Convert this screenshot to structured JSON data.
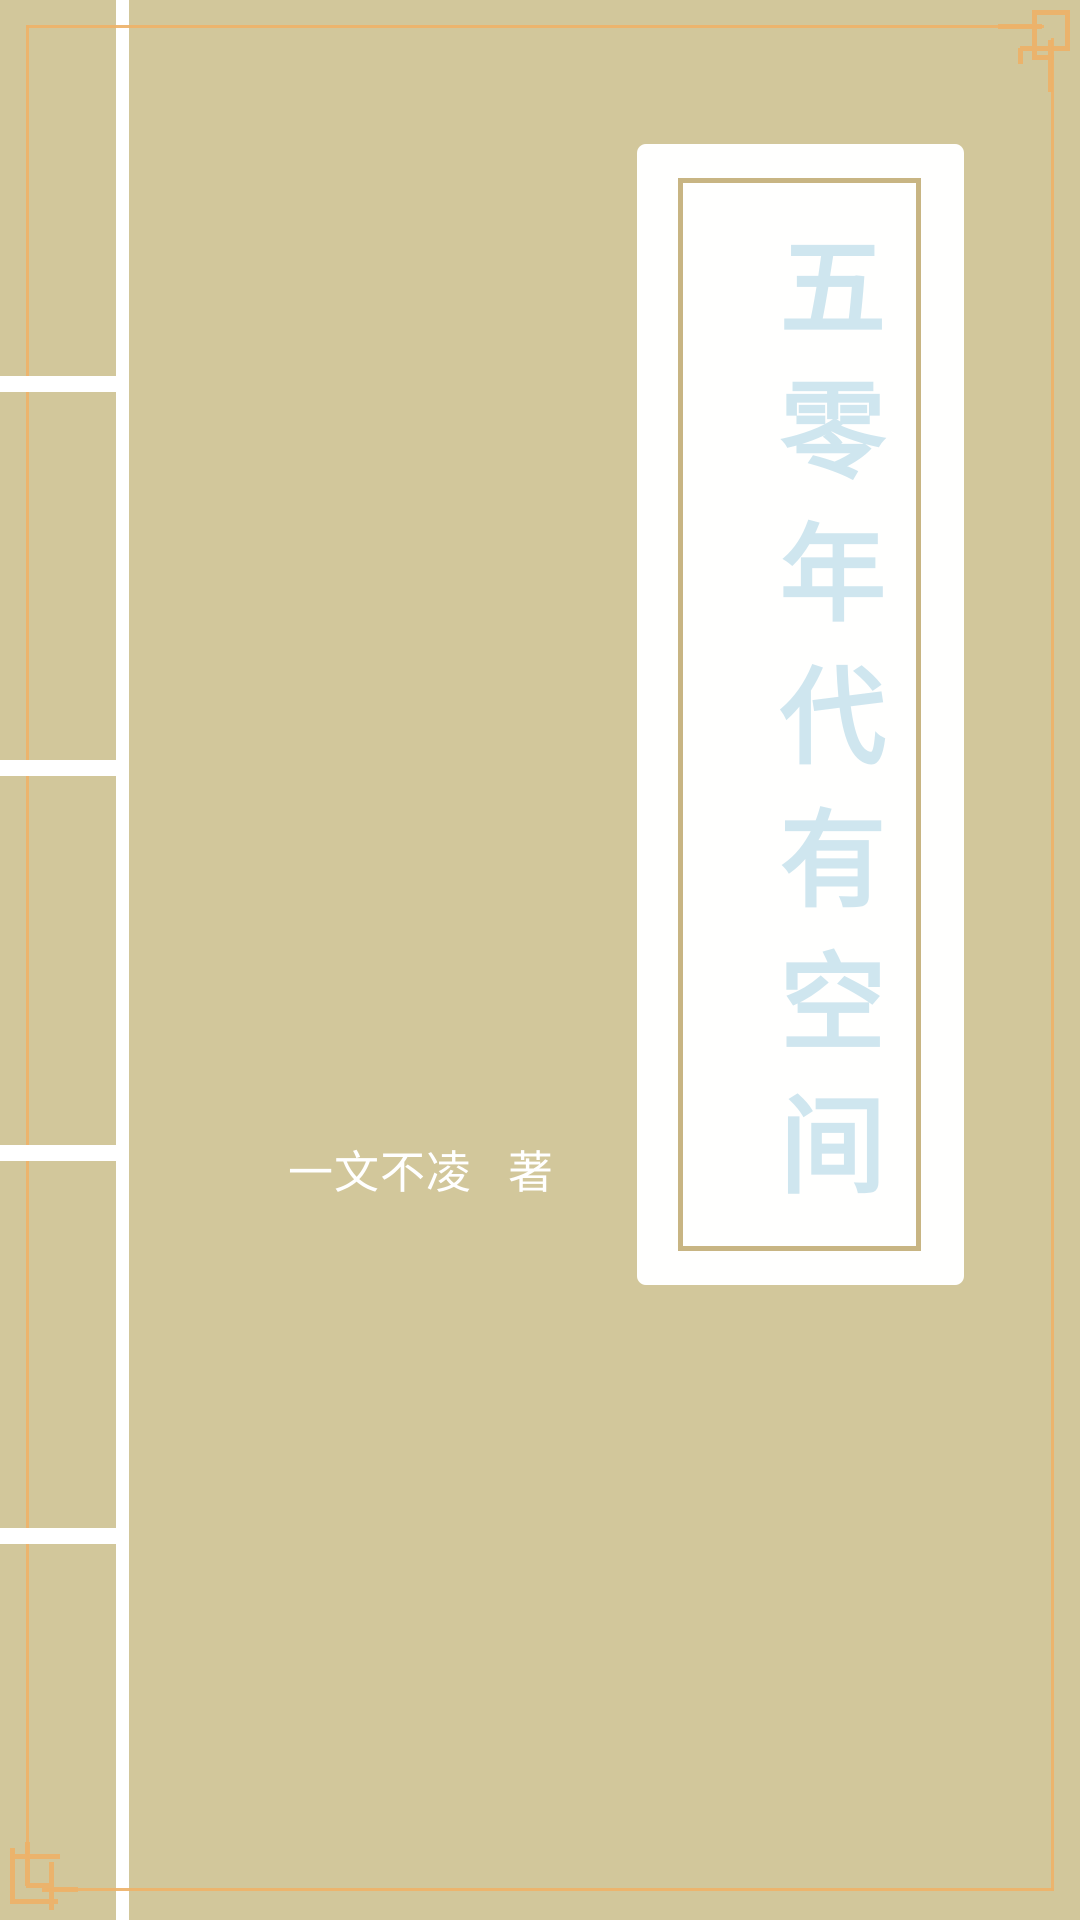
{
  "book_cover": {
    "title": "五零年代有空间",
    "author": "一文不凌",
    "author_suffix": "著"
  },
  "icons": {
    "corner_ornament": "chinese-fret-corner"
  },
  "theme": {
    "bg": "#d2c79b",
    "gold": "#eeb269",
    "spine": "#ffffff",
    "panel_border": "#c8b583",
    "title_text": "#cfe6ef",
    "author_text": "#ffffff"
  }
}
